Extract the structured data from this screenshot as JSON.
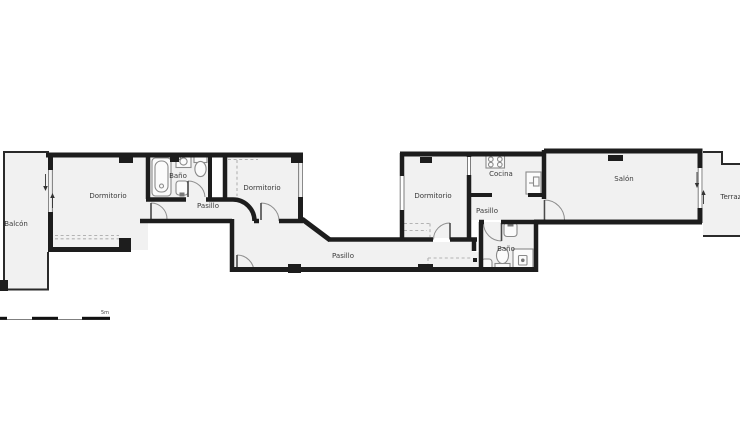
{
  "floor_plan": {
    "rooms": [
      {
        "id": "balcon",
        "label": "Balcón"
      },
      {
        "id": "dormitorio-1",
        "label": "Dormitorio"
      },
      {
        "id": "bano-1",
        "label": "Baño"
      },
      {
        "id": "pasillo-1",
        "label": "Pasillo"
      },
      {
        "id": "dormitorio-2",
        "label": "Dormitorio"
      },
      {
        "id": "pasillo-2",
        "label": "Pasillo"
      },
      {
        "id": "dormitorio-3",
        "label": "Dormitorio"
      },
      {
        "id": "cocina",
        "label": "Cocina"
      },
      {
        "id": "pasillo-3",
        "label": "Pasillo"
      },
      {
        "id": "bano-2",
        "label": "Baño"
      },
      {
        "id": "salon",
        "label": "Salón"
      },
      {
        "id": "terraza",
        "label": "Terraza"
      }
    ],
    "scale_bar": {
      "label": "5m"
    },
    "fixtures": [
      "bathtub-icon",
      "washing-machine-icon",
      "toilet-icon",
      "sink-icon",
      "stove-icon",
      "fridge-icon",
      "shower-icon"
    ],
    "colors": {
      "wall": "#1d1d1d",
      "room_fill": "#f1f1f1",
      "background": "#ffffff",
      "fixture_stroke": "#8a8a8a",
      "dash": "#b3b3b3",
      "label": "#3a3a3a"
    }
  }
}
